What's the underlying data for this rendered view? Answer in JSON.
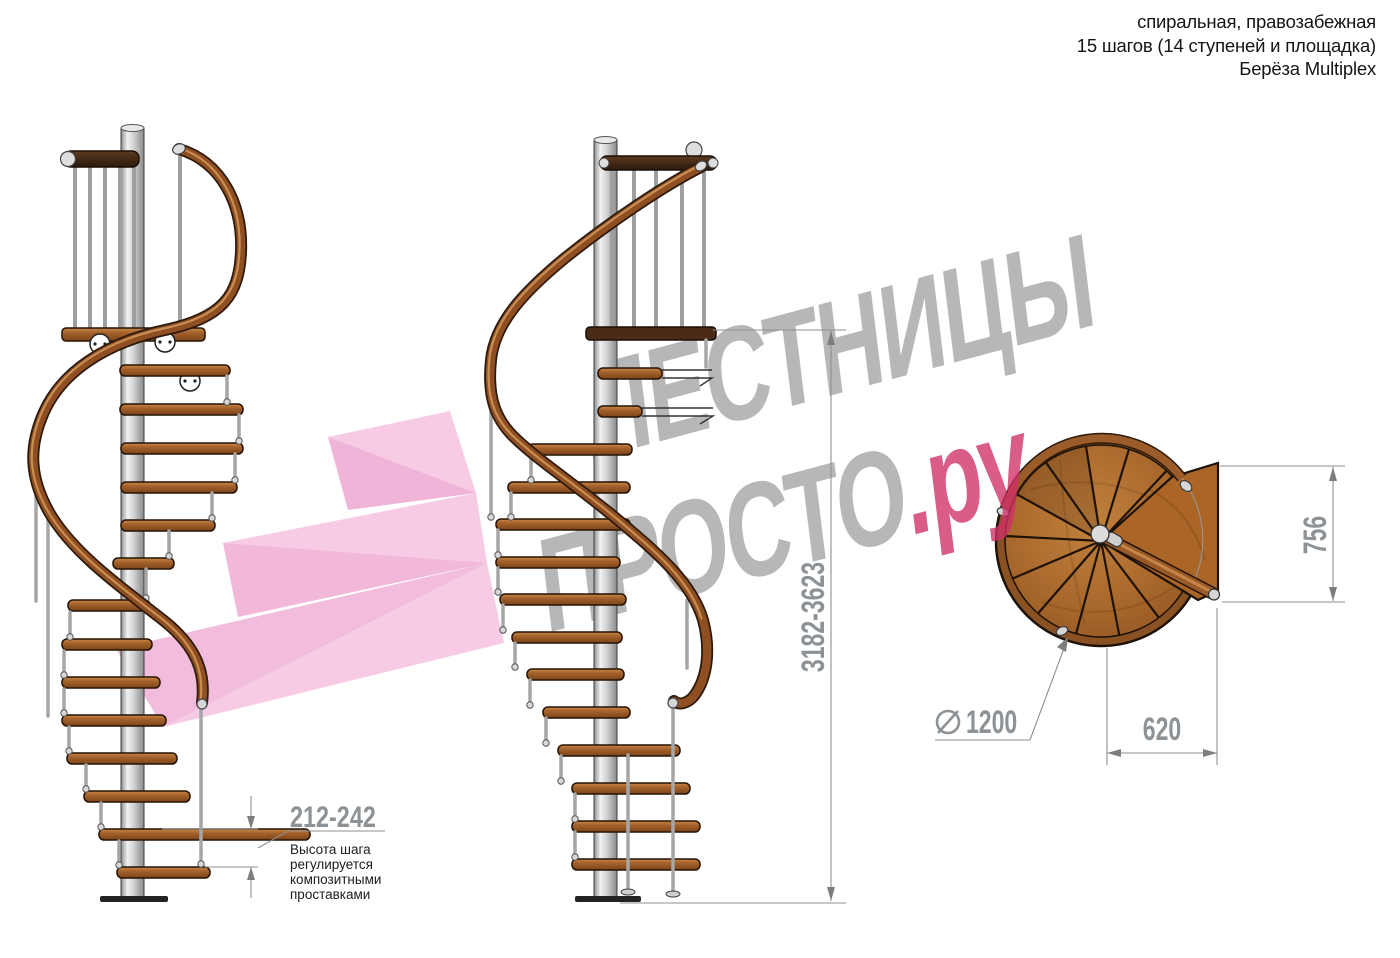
{
  "header": {
    "line1": "спиральная, правозабежная",
    "line2": "15 шагов (14 ступеней и площадка)",
    "line3": "Берёза Multiplex"
  },
  "watermark": {
    "line1": "ЛЕСТНИЦЫ",
    "line2_gray": "ПРОСТО",
    "line2_pink": ".ру",
    "gray_color": "#707070",
    "pink_color": "#cf2f66",
    "logo_pink_color": "#ee82c2"
  },
  "dimensions": {
    "total_height": "3182-3623",
    "step_height": "212-242",
    "landing_depth": "756",
    "landing_width": "620",
    "diameter_value": "1200",
    "diameter_symbol": "⌀"
  },
  "step_note": {
    "lines": [
      "Высота шага",
      "регулируется",
      "композитными",
      "проставками"
    ]
  },
  "materials": {
    "wood_light": "#b97a38",
    "wood_mid": "#a2602a",
    "wood_dark": "#4a2c16",
    "steel": "#c9c9c9",
    "dim_text_color": "#8d9297"
  }
}
